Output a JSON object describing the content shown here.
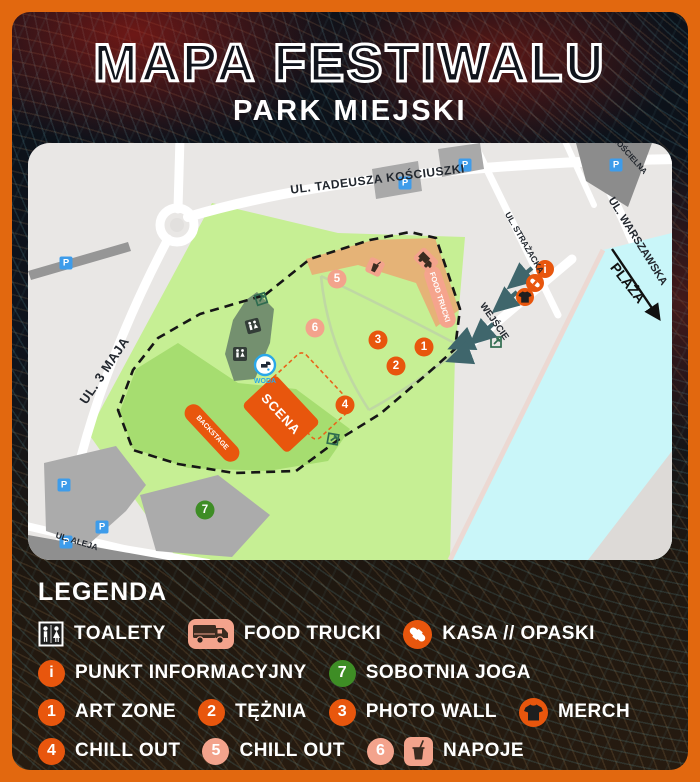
{
  "poster": {
    "title": "MAPA FESTIWALU",
    "subtitle": "PARK MIEJSKI"
  },
  "map": {
    "streets": {
      "kosciuszki": "UL. TADEUSZA KOŚCIUSZKI",
      "trzeciego_maja": "UL. 3 MAJA",
      "strazacka": "UL. STRAŻACKA",
      "warszawska": "UL. WARSZAWSKA",
      "koscielna": "KOŚCIELNA",
      "aleja": "UL. ALEJA"
    },
    "labels": {
      "wejscie": "WEJŚCIE",
      "plaza": "PLAŻA",
      "scena": "SCENA",
      "backstage": "BACKSTAGE",
      "food_trucki": "FOOD TRUCKI",
      "woda": "WODA",
      "parking": "P",
      "info": "i"
    },
    "markers": {
      "n1": "1",
      "n2": "2",
      "n3": "3",
      "n4": "4",
      "n5": "5",
      "n6": "6",
      "n7": "7"
    }
  },
  "legend": {
    "heading": "LEGENDA",
    "items": [
      {
        "icon": "toilets-icon",
        "label": "TOALETY"
      },
      {
        "icon": "food-truck-icon",
        "label": "FOOD TRUCKI"
      },
      {
        "icon": "wristband-icon",
        "label": "KASA // OPASKI"
      },
      {
        "badge": "i",
        "badge_color": "orange",
        "label": "PUNKT INFORMACYJNY"
      },
      {
        "badge": "7",
        "badge_color": "green",
        "label": "SOBOTNIA JOGA"
      },
      {
        "badge": "1",
        "badge_color": "orange",
        "label": "ART ZONE"
      },
      {
        "badge": "2",
        "badge_color": "orange",
        "label": "TĘŻNIA"
      },
      {
        "badge": "3",
        "badge_color": "orange",
        "label": "PHOTO WALL"
      },
      {
        "icon": "tshirt-icon",
        "label": "MERCH"
      },
      {
        "badge": "4",
        "badge_color": "orange",
        "label": "CHILL OUT"
      },
      {
        "badge": "5",
        "badge_color": "salmon",
        "label": "CHILL OUT"
      },
      {
        "badge": "6",
        "badge_color": "salmon",
        "icon": "drink-icon",
        "label": "NAPOJE"
      }
    ]
  },
  "colors": {
    "frame_orange": "#E2680F",
    "marker_orange": "#E8560D",
    "marker_salmon": "#F3A38C",
    "marker_green": "#3E8D25",
    "parking_blue": "#3E9CEA",
    "park_green": "#C6EF94",
    "festival_green": "#A6DD70",
    "food_zone_tan": "#E5B377",
    "toilets_sage": "#74906F",
    "water_cyan": "#C9F6F9"
  }
}
